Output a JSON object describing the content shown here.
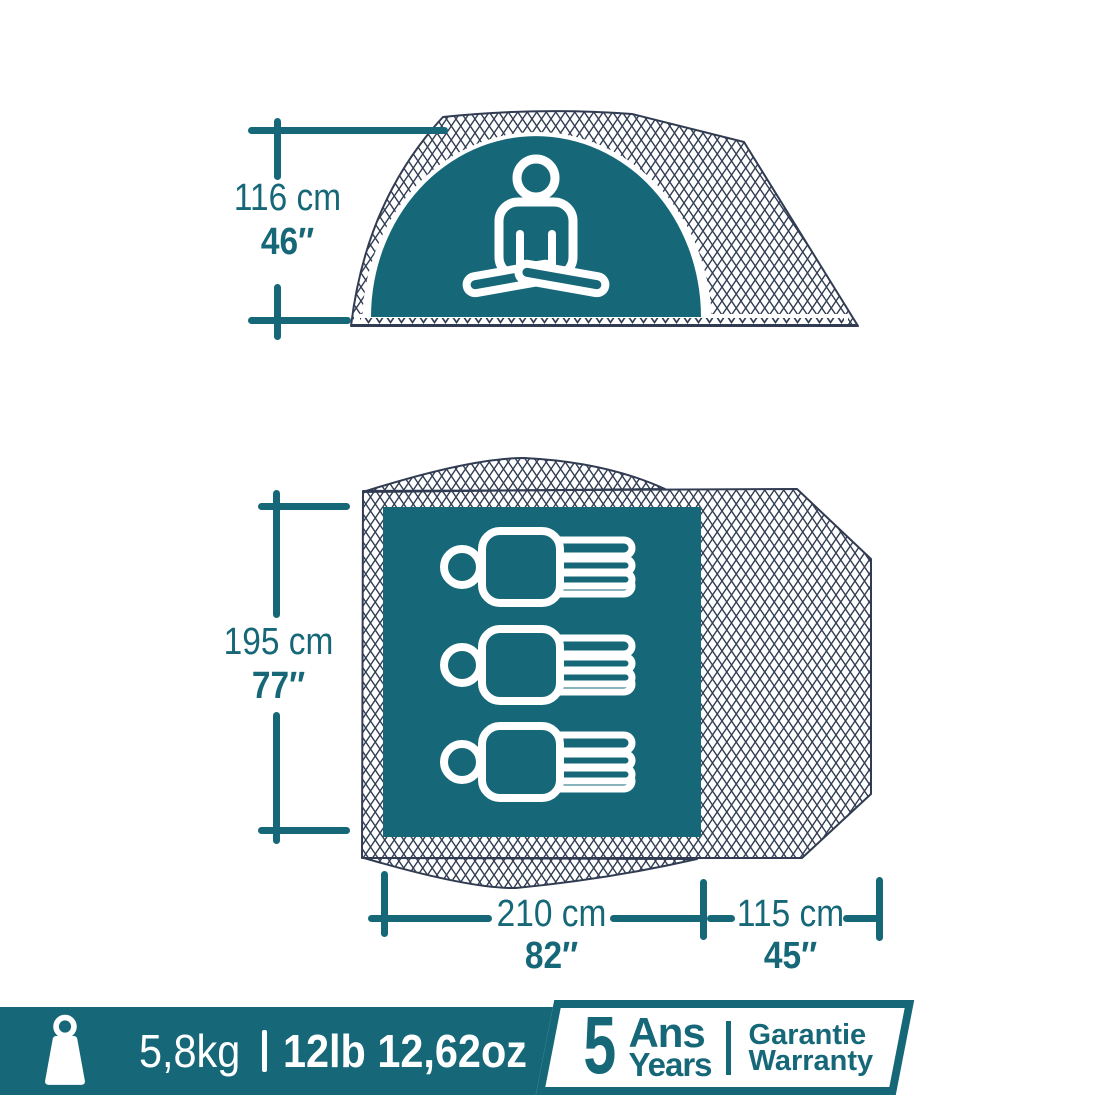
{
  "colors": {
    "teal": "#166878",
    "mesh_line": "#313C52",
    "white": "#FFFFFF"
  },
  "icons": {
    "weight": "weight-icon",
    "meditating_person": "meditating-person-icon",
    "sleeping_person": "sleeping-person-icon"
  },
  "side_view": {
    "height_cm": "116 cm",
    "height_in": "46″"
  },
  "floor_plan": {
    "sleeper_count": 3,
    "depth_cm": "195 cm",
    "depth_in": "77″",
    "width_cm": "210 cm",
    "width_in": "82″",
    "vestibule_cm": "115 cm",
    "vestibule_in": "45″"
  },
  "footer": {
    "weight_kg": "5,8kg",
    "separator": "|",
    "weight_lb": "12lb 12,62oz",
    "warranty": {
      "years_number": "5",
      "years_fr": "Ans",
      "years_en": "Years",
      "guarantee_fr": "Garantie",
      "guarantee_en": "Warranty"
    }
  }
}
